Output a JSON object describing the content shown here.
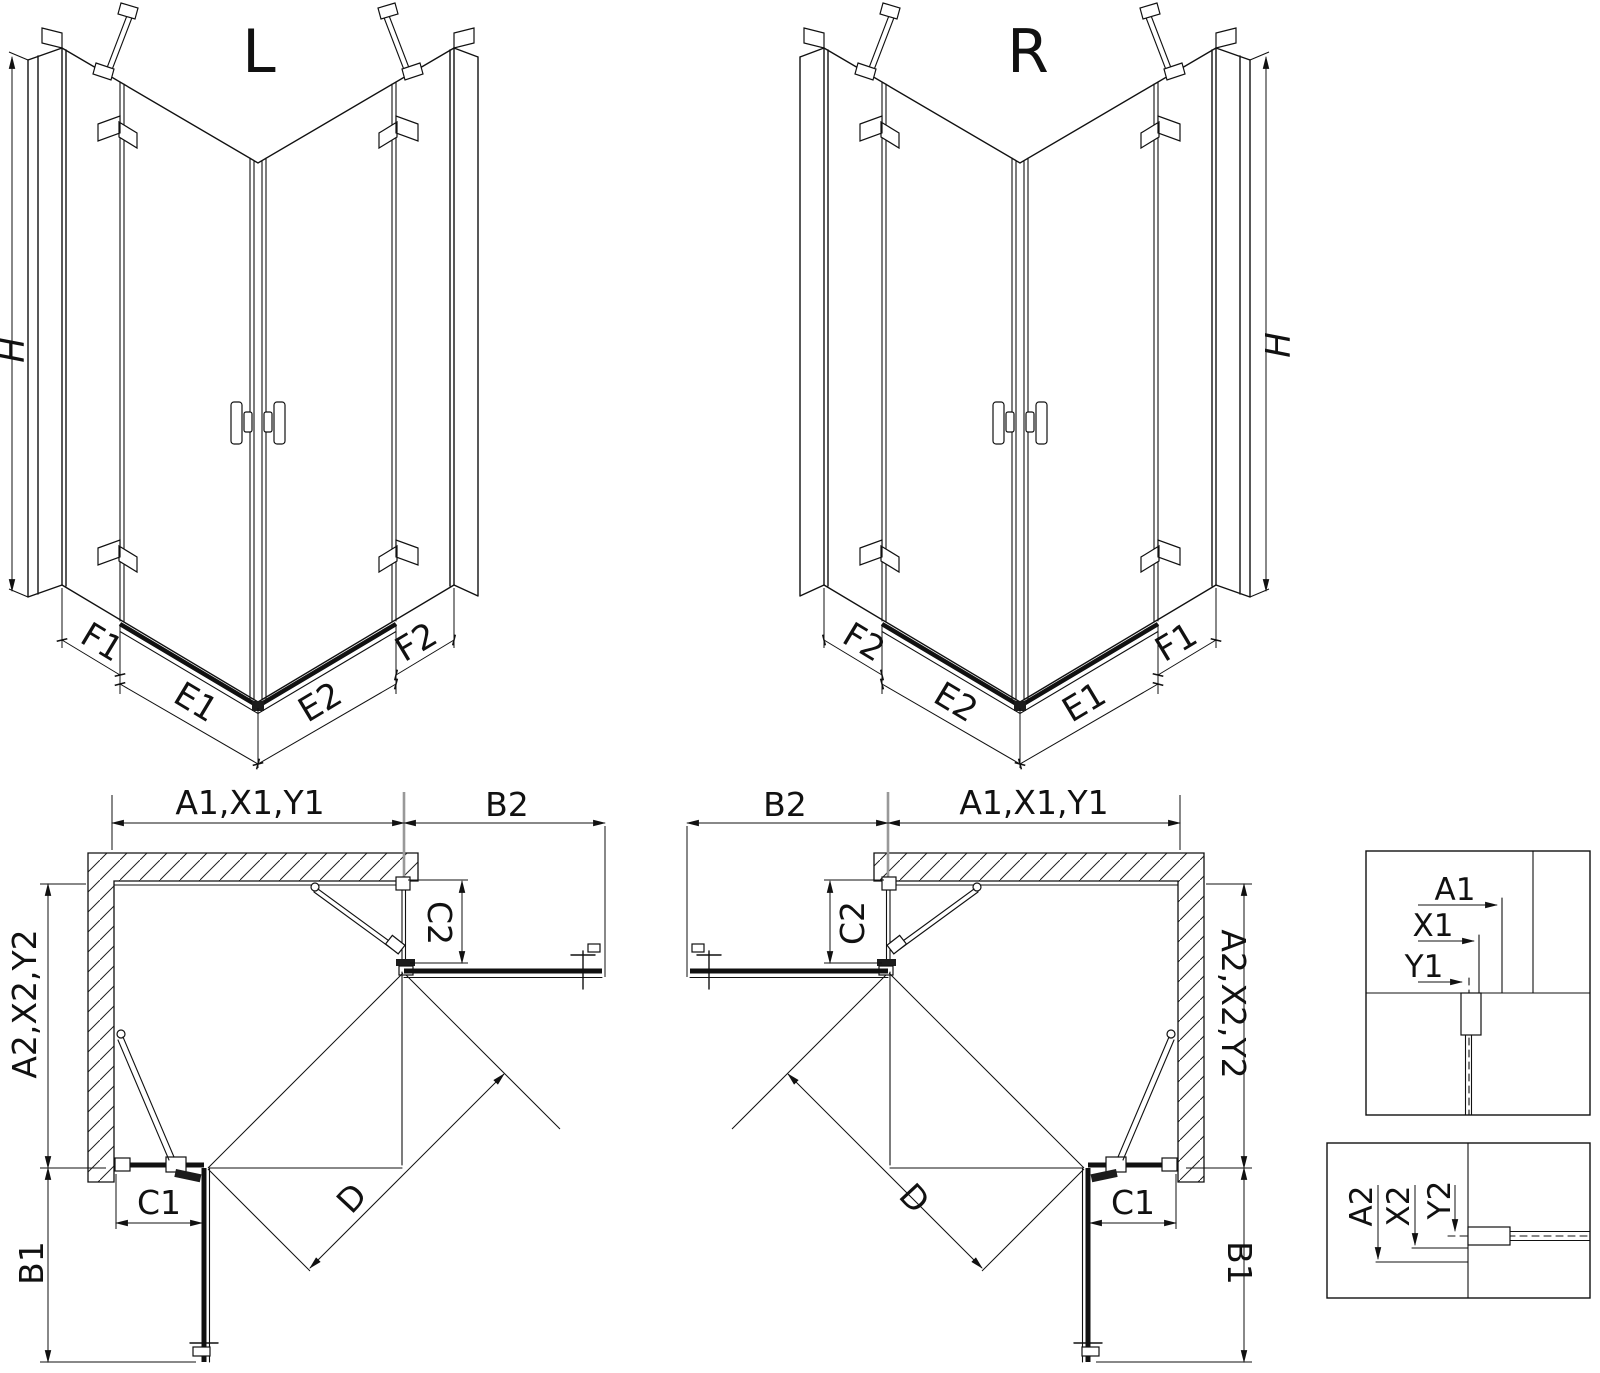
{
  "iso_left": {
    "title": "L",
    "height": "H",
    "seg_f1": "F1",
    "seg_e1": "E1",
    "seg_e2": "E2",
    "seg_f2": "F2"
  },
  "iso_right": {
    "title": "R",
    "height": "H",
    "seg_f2": "F2",
    "seg_e2": "E2",
    "seg_e1": "E1",
    "seg_f1": "F1"
  },
  "plan_left": {
    "width": "A1,X1,Y1",
    "door_b2": "B2",
    "panel_c2": "C2",
    "depth": "A2,X2,Y2",
    "panel_c1": "C1",
    "door_b1": "B1",
    "diagonal": "D"
  },
  "plan_right": {
    "width": "A1,X1,Y1",
    "door_b2": "B2",
    "panel_c2": "C2",
    "depth": "A2,X2,Y2",
    "panel_c1": "C1",
    "door_b1": "B1",
    "diagonal": "D"
  },
  "detail_width": {
    "a1": "A1",
    "x1": "X1",
    "y1": "Y1"
  },
  "detail_depth": {
    "a2": "A2",
    "x2": "X2",
    "y2": "Y2"
  }
}
